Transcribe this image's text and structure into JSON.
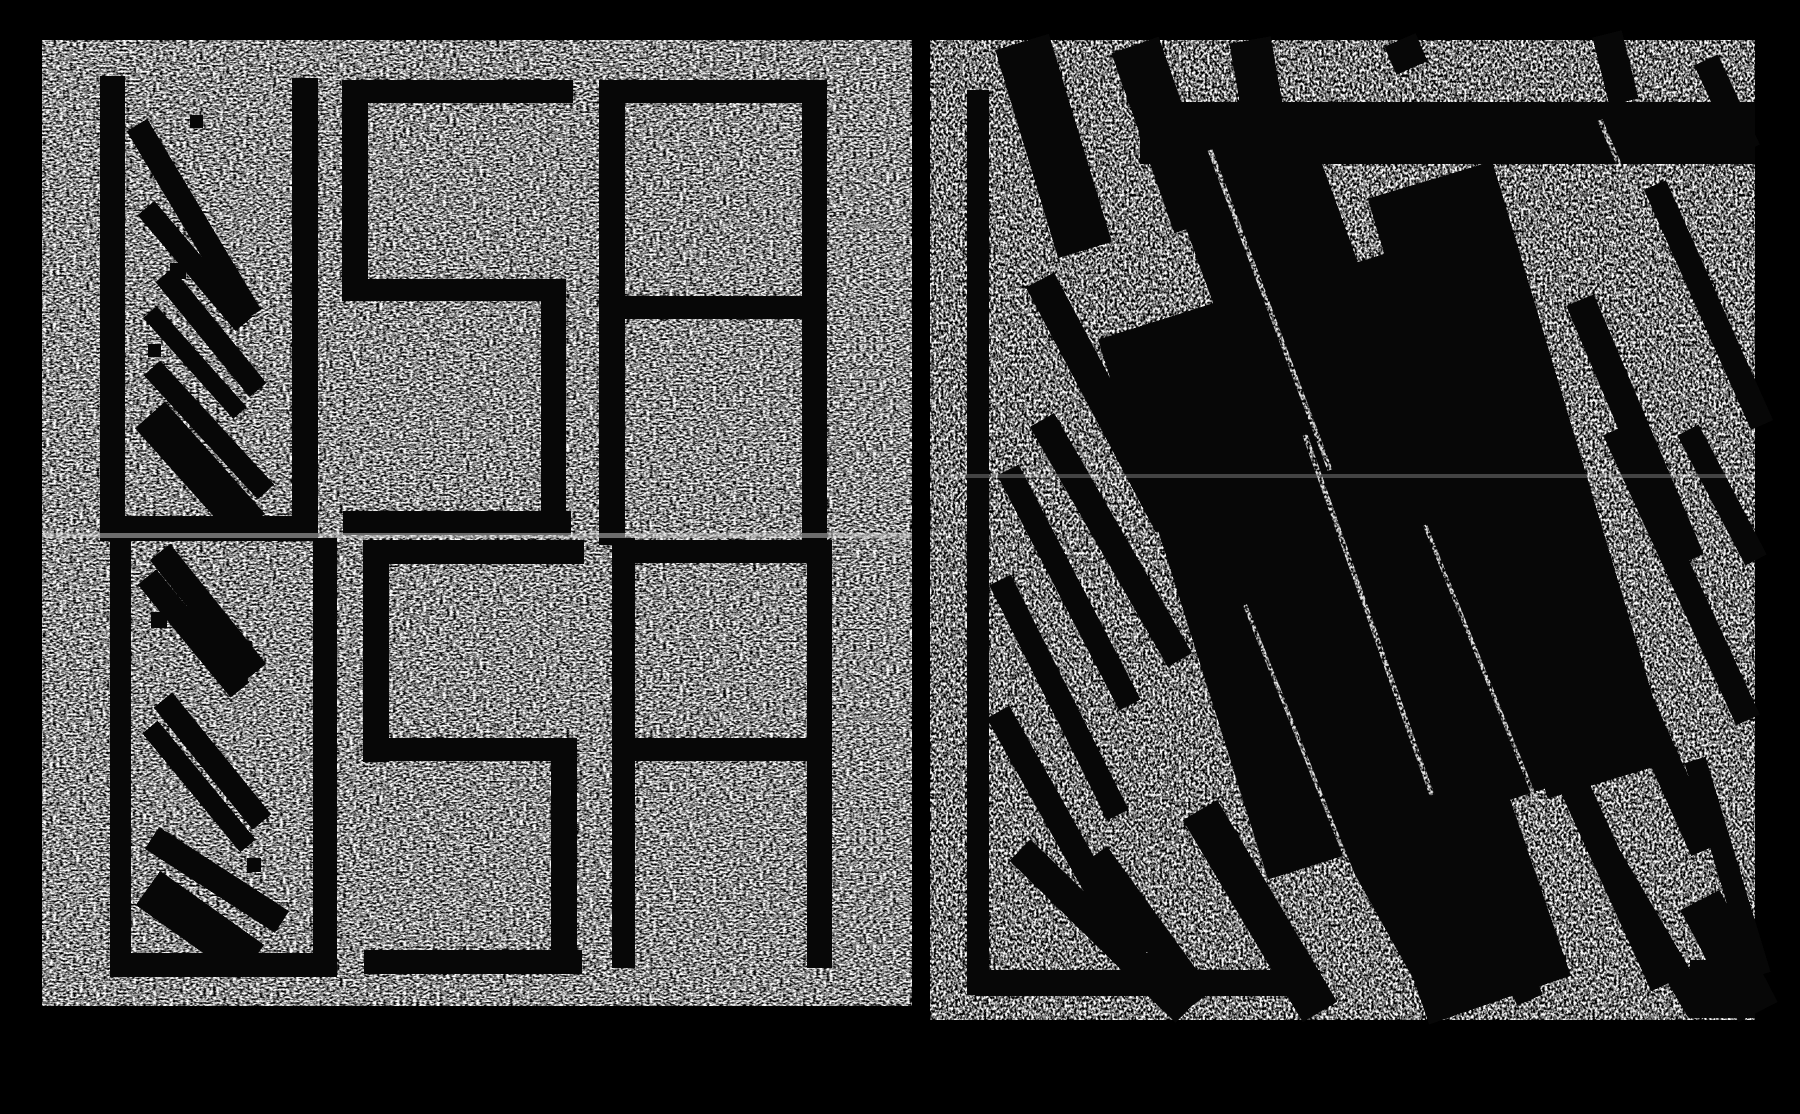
{
  "artwork": {
    "title": "USA diptych print — left panel with stencil letters, right panel obscured by black scribble bars",
    "depicted_text": "USA USA",
    "colors": {
      "background": "#000000",
      "ink": "#070707",
      "left_base": "#8e8e8e",
      "right_base": "#6b6b6b",
      "seam": "#d2d2d2"
    },
    "panels": {
      "left": {
        "label": "left-panel-usa-clear",
        "x": 42,
        "y": 40,
        "w": 870,
        "h": 966,
        "filter": "noiseL",
        "seam": {
          "y": 533,
          "h": 5,
          "opacity": 0.5
        }
      },
      "right": {
        "label": "right-panel-usa-obscured",
        "x": 930,
        "y": 40,
        "w": 825,
        "h": 980,
        "filter": "noiseR",
        "seam": {
          "y": 474,
          "h": 4,
          "opacity": 0.3
        }
      }
    },
    "geometry": {
      "left": {
        "rects": [
          [
            100,
            76,
            25,
            465
          ],
          [
            292,
            78,
            26,
            463
          ],
          [
            100,
            516,
            218,
            25
          ],
          [
            342,
            80,
            231,
            23
          ],
          [
            342,
            80,
            26,
            221
          ],
          [
            343,
            279,
            223,
            22
          ],
          [
            541,
            279,
            25,
            256
          ],
          [
            343,
            511,
            228,
            24
          ],
          [
            599,
            80,
            26,
            465
          ],
          [
            599,
            80,
            228,
            23
          ],
          [
            802,
            80,
            25,
            465
          ],
          [
            624,
            296,
            179,
            23
          ],
          [
            110,
            538,
            21,
            439
          ],
          [
            313,
            538,
            24,
            439
          ],
          [
            110,
            953,
            227,
            24
          ],
          [
            363,
            540,
            221,
            24
          ],
          [
            363,
            540,
            26,
            222
          ],
          [
            364,
            738,
            213,
            23
          ],
          [
            551,
            738,
            26,
            236
          ],
          [
            364,
            950,
            218,
            24
          ],
          [
            612,
            538,
            23,
            430
          ],
          [
            612,
            540,
            220,
            23
          ],
          [
            807,
            540,
            25,
            428
          ],
          [
            630,
            738,
            180,
            23
          ],
          [
            152,
            218,
            15,
            15
          ],
          [
            170,
            263,
            16,
            16
          ],
          [
            148,
            344,
            13,
            13
          ],
          [
            237,
            641,
            15,
            15
          ],
          [
            151,
            612,
            16,
            16
          ],
          [
            247,
            858,
            14,
            14
          ],
          [
            190,
            115,
            13,
            13
          ]
        ],
        "bars": [
          [
            137,
            125,
            251,
            316,
            24
          ],
          [
            146,
            208,
            244,
            324,
            22
          ],
          [
            164,
            275,
            258,
            390,
            22
          ],
          [
            150,
            312,
            240,
            413,
            18
          ],
          [
            152,
            368,
            266,
            492,
            22
          ],
          [
            150,
            415,
            250,
            527,
            40
          ],
          [
            160,
            552,
            256,
            672,
            26
          ],
          [
            147,
            577,
            240,
            690,
            24
          ],
          [
            163,
            700,
            262,
            822,
            24
          ],
          [
            150,
            727,
            248,
            846,
            20
          ],
          [
            152,
            838,
            282,
            922,
            26
          ],
          [
            148,
            888,
            252,
            962,
            42
          ]
        ],
        "trails": []
      },
      "right": {
        "rects": [
          [
            967,
            90,
            22,
            905
          ],
          [
            975,
            970,
            345,
            26
          ],
          [
            1140,
            102,
            615,
            62
          ],
          [
            1690,
            960,
            65,
            58
          ]
        ],
        "bars": [
          [
            1022,
            42,
            1085,
            250,
            56
          ],
          [
            1135,
            45,
            1198,
            225,
            50
          ],
          [
            1250,
            40,
            1262,
            108,
            42
          ],
          [
            1400,
            40,
            1412,
            68,
            34
          ],
          [
            1607,
            34,
            1624,
            102,
            30
          ],
          [
            1706,
            60,
            1748,
            150,
            26
          ],
          [
            1040,
            280,
            1170,
            525,
            32
          ],
          [
            1042,
            420,
            1180,
            660,
            28
          ],
          [
            1008,
            470,
            1130,
            705,
            24
          ],
          [
            1000,
            580,
            1118,
            815,
            24
          ],
          [
            998,
            712,
            1136,
            958,
            26
          ],
          [
            1020,
            850,
            1186,
            1012,
            30
          ],
          [
            1230,
            130,
            1430,
            680,
            150
          ],
          [
            1365,
            260,
            1540,
            790,
            150
          ],
          [
            1300,
            420,
            1500,
            1000,
            150
          ],
          [
            1160,
            320,
            1330,
            860,
            130
          ],
          [
            1430,
            180,
            1610,
            780,
            130
          ],
          [
            1580,
            300,
            1690,
            560,
            30
          ],
          [
            1615,
            430,
            1748,
            720,
            26
          ],
          [
            1688,
            430,
            1756,
            560,
            24
          ],
          [
            1575,
            560,
            1705,
            850,
            30
          ],
          [
            1535,
            700,
            1665,
            985,
            30
          ],
          [
            1590,
            825,
            1700,
            1012,
            26
          ],
          [
            1655,
            185,
            1762,
            425,
            24
          ],
          [
            1695,
            760,
            1760,
            975,
            22
          ],
          [
            1700,
            900,
            1758,
            1012,
            44
          ],
          [
            1200,
            810,
            1320,
            1012,
            40
          ],
          [
            1315,
            770,
            1450,
            1012,
            32
          ],
          [
            1395,
            700,
            1530,
            1000,
            28
          ],
          [
            1095,
            855,
            1200,
            1000,
            30
          ]
        ],
        "trails": [
          [
            1210,
            150,
            1330,
            470,
            5
          ],
          [
            1305,
            435,
            1432,
            795,
            5
          ],
          [
            1425,
            525,
            1558,
            855,
            4
          ],
          [
            1245,
            605,
            1362,
            898,
            4
          ],
          [
            1600,
            120,
            1660,
            260,
            5
          ]
        ]
      }
    }
  }
}
